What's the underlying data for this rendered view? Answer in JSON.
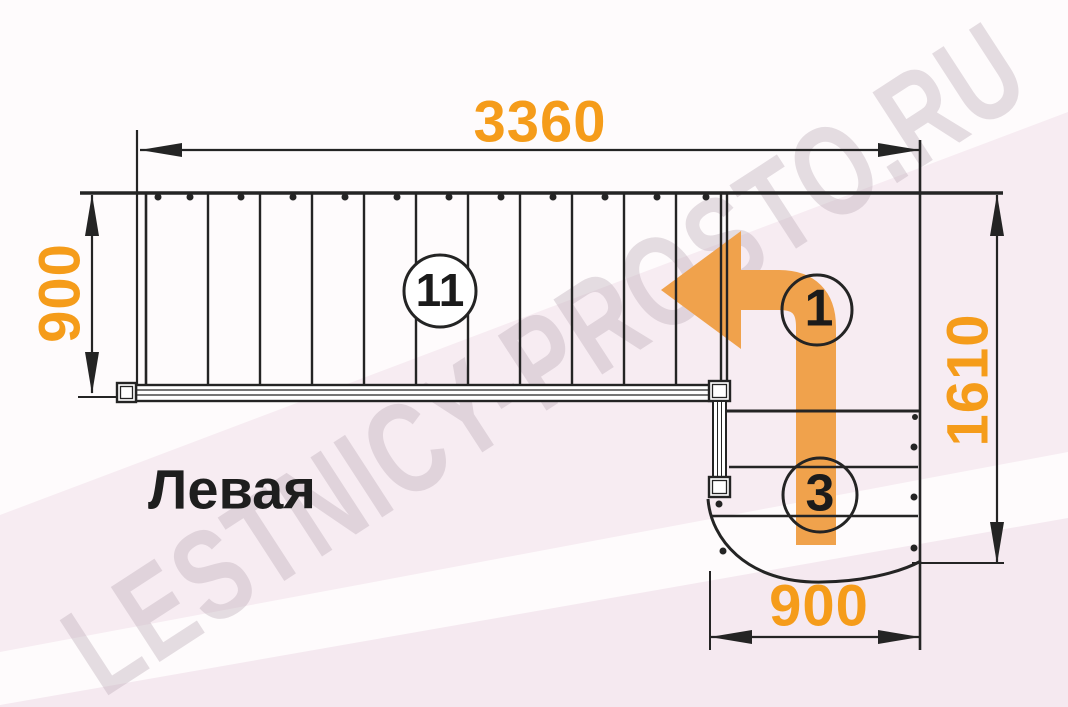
{
  "title": "Левая",
  "watermark": "LESTNICY-PROSTO.RU",
  "dimensions": {
    "top": {
      "value": "3360",
      "unit": "mm",
      "orientation": "horizontal"
    },
    "left": {
      "value": "900",
      "unit": "mm",
      "orientation": "vertical"
    },
    "right": {
      "value": "1610",
      "unit": "mm",
      "orientation": "vertical"
    },
    "bottom": {
      "value": "900",
      "unit": "mm",
      "orientation": "horizontal"
    }
  },
  "step_labels": {
    "upper_flight": "11",
    "turn": "1",
    "lower_flight": "3"
  },
  "colors": {
    "accent-orange": "#F59C1A",
    "arrow-orange": "#F0A24C",
    "line-dark": "#242424",
    "bg-base": "#FEFBFC",
    "band-pink": "#F7ECF2",
    "band-pink-deep": "#F5E9F0",
    "watermark": "rgba(186,170,182,0.38)"
  }
}
